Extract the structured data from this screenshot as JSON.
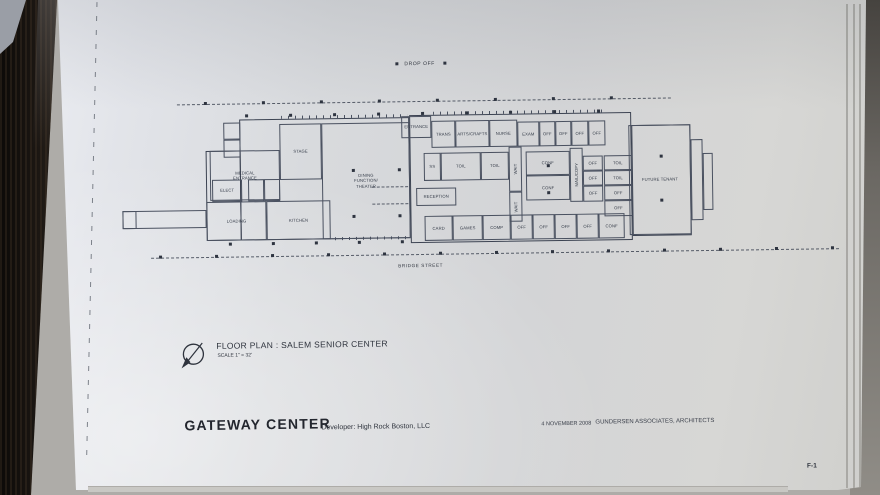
{
  "site": {
    "drop_off": "DROP OFF",
    "street": "BRIDGE STREET"
  },
  "title_block": {
    "drawing_title": "FLOOR PLAN : SALEM SENIOR CENTER",
    "scale": "SCALE 1\" = 32'",
    "project": "GATEWAY  CENTER",
    "developer": "Developer: High Rock Boston, LLC",
    "date": "4 NOVEMBER 2008",
    "architect": "GUNDERSEN ASSOCIATES, ARCHITECTS",
    "sheet_number": "F-1"
  },
  "colors": {
    "ink": "#353b48",
    "paper": "#d9dadd",
    "wood": "#1c1713"
  },
  "floor_plan": {
    "rooms": [
      {
        "id": "entrance",
        "label": "ENTRANCE",
        "x": 402,
        "y": 116,
        "w": 30,
        "h": 22
      },
      {
        "id": "trans",
        "label": "TRANS",
        "x": 432,
        "y": 121,
        "w": 24,
        "h": 27
      },
      {
        "id": "arts-crafts",
        "label": "ARTS/CRAFTS",
        "x": 456,
        "y": 121,
        "w": 34,
        "h": 27
      },
      {
        "id": "nurse",
        "label": "NURSE",
        "x": 490,
        "y": 121,
        "w": 28,
        "h": 27
      },
      {
        "id": "exam",
        "label": "EXAM",
        "x": 518,
        "y": 123,
        "w": 22,
        "h": 25
      },
      {
        "id": "off-t1",
        "label": "OFF",
        "x": 540,
        "y": 123,
        "w": 16,
        "h": 25
      },
      {
        "id": "off-t2",
        "label": "OFF",
        "x": 556,
        "y": 123,
        "w": 16,
        "h": 25
      },
      {
        "id": "off-t3",
        "label": "OFF",
        "x": 572,
        "y": 123,
        "w": 17,
        "h": 25
      },
      {
        "id": "off-t4",
        "label": "OFF",
        "x": 589,
        "y": 123,
        "w": 17,
        "h": 25
      },
      {
        "id": "ss",
        "label": "SS",
        "x": 424,
        "y": 153,
        "w": 17,
        "h": 28
      },
      {
        "id": "toil-1",
        "label": "TOIL",
        "x": 441,
        "y": 153,
        "w": 40,
        "h": 28
      },
      {
        "id": "toil-2",
        "label": "TOIL",
        "x": 481,
        "y": 153,
        "w": 28,
        "h": 28
      },
      {
        "id": "wait-1",
        "label": "WAIT",
        "x": 509,
        "y": 148,
        "w": 13,
        "h": 45,
        "vertical": true
      },
      {
        "id": "conf-1",
        "label": "CONF",
        "x": 526,
        "y": 153,
        "w": 44,
        "h": 24
      },
      {
        "id": "conf-2",
        "label": "CONF",
        "x": 526,
        "y": 177,
        "w": 44,
        "h": 25
      },
      {
        "id": "mail-copy",
        "label": "MAIL/COPY",
        "x": 570,
        "y": 150,
        "w": 13,
        "h": 54,
        "vertical": true
      },
      {
        "id": "off-m1",
        "label": "OFF",
        "x": 583,
        "y": 158,
        "w": 20,
        "h": 15
      },
      {
        "id": "off-m2",
        "label": "OFF",
        "x": 583,
        "y": 173,
        "w": 20,
        "h": 15
      },
      {
        "id": "off-m3",
        "label": "OFF",
        "x": 583,
        "y": 188,
        "w": 20,
        "h": 16
      },
      {
        "id": "reception",
        "label": "RECEPTION",
        "x": 416,
        "y": 188,
        "w": 40,
        "h": 18
      },
      {
        "id": "wait-2",
        "label": "WAIT",
        "x": 509,
        "y": 193,
        "w": 13,
        "h": 30,
        "vertical": true
      },
      {
        "id": "card",
        "label": "CARD",
        "x": 424,
        "y": 216,
        "w": 28,
        "h": 25
      },
      {
        "id": "games",
        "label": "GAMES",
        "x": 452,
        "y": 216,
        "w": 30,
        "h": 25
      },
      {
        "id": "comp",
        "label": "COMP",
        "x": 482,
        "y": 216,
        "w": 28,
        "h": 25
      },
      {
        "id": "off-b1",
        "label": "OFF",
        "x": 510,
        "y": 216,
        "w": 22,
        "h": 25
      },
      {
        "id": "off-b2",
        "label": "OFF",
        "x": 532,
        "y": 216,
        "w": 22,
        "h": 25
      },
      {
        "id": "off-b3",
        "label": "OFF",
        "x": 554,
        "y": 216,
        "w": 22,
        "h": 25
      },
      {
        "id": "off-b4",
        "label": "OFF",
        "x": 576,
        "y": 216,
        "w": 22,
        "h": 25
      },
      {
        "id": "conf-b",
        "label": "CONF",
        "x": 598,
        "y": 216,
        "w": 26,
        "h": 25
      },
      {
        "id": "toil-r1",
        "label": "TOIL",
        "x": 604,
        "y": 158,
        "w": 28,
        "h": 15
      },
      {
        "id": "toil-r2",
        "label": "TOIL",
        "x": 604,
        "y": 173,
        "w": 28,
        "h": 15
      },
      {
        "id": "off-r1",
        "label": "OFF",
        "x": 604,
        "y": 188,
        "w": 28,
        "h": 15
      },
      {
        "id": "off-r2",
        "label": "OFF",
        "x": 604,
        "y": 203,
        "w": 28,
        "h": 16
      },
      {
        "id": "medical-entrance",
        "label": "MEDICAL\nENTRANCE",
        "x": 210,
        "y": 148,
        "w": 70,
        "h": 50
      },
      {
        "id": "stage",
        "label": "STAGE",
        "x": 280,
        "y": 122,
        "w": 42,
        "h": 56
      },
      {
        "id": "dining",
        "label": "DINING\nFUNCTION/\nTHEATER",
        "x": 322,
        "y": 122,
        "w": 88,
        "h": 116
      },
      {
        "id": "elect",
        "label": "ELECT",
        "x": 212,
        "y": 177,
        "w": 30,
        "h": 22
      },
      {
        "id": "loading",
        "label": "LOADING",
        "x": 206,
        "y": 199,
        "w": 60,
        "h": 39
      },
      {
        "id": "kitchen",
        "label": "KITCHEN",
        "x": 266,
        "y": 199,
        "w": 64,
        "h": 39
      },
      {
        "id": "future-tenant",
        "label": "FUTURE TENANT",
        "x": 629,
        "y": 128,
        "w": 62,
        "h": 110
      }
    ]
  }
}
